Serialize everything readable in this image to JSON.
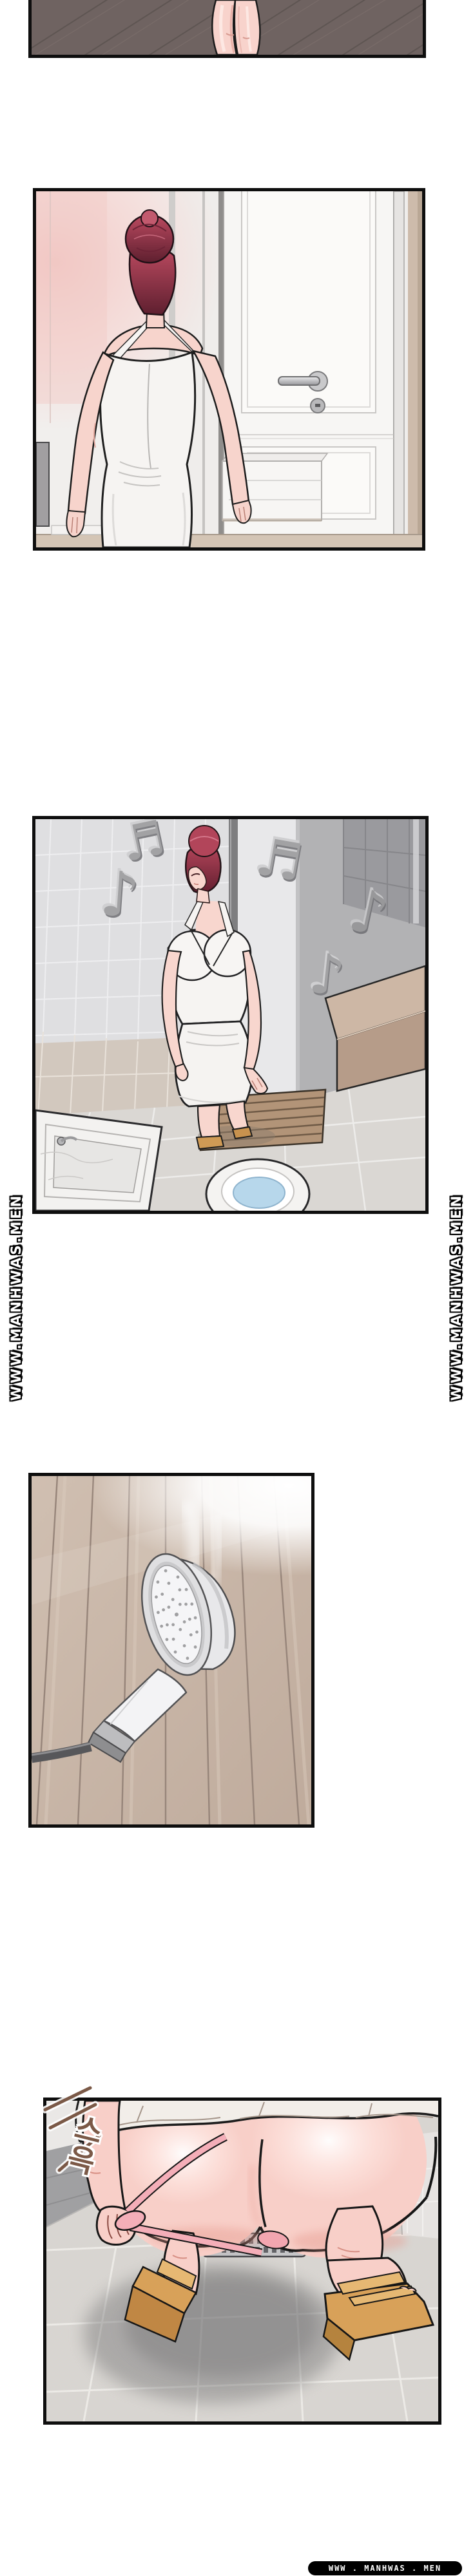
{
  "page": {
    "kind": "manhwa-webtoon-page",
    "background": "#ffffff",
    "panel_border": "#0e0e0e"
  },
  "watermarks": {
    "side": {
      "text": "WWW.MANHWAS.MEN",
      "color": "#ffffff",
      "outline": "#000000"
    },
    "bottom": {
      "text": "WWW . MANHWAS . MEN",
      "color": "#ffffff",
      "bg": "#000000"
    }
  },
  "sfx": {
    "text": "스윽",
    "color": "#7b5947"
  },
  "icons": {
    "eighth_note": "♪",
    "beamed_note": "♬"
  },
  "palette": {
    "skin": "#f8cfc8",
    "hair_red": "#b2455a",
    "dress_white": "#f6f4f2",
    "dark_wood_floor": "#6f6361",
    "wood_wall": "#c8b5a7",
    "tile_gray": "#dedee0",
    "note_gray": "#a2a2a4",
    "counter_tan": "#cdb7a5",
    "sandal_tan": "#d8a159",
    "panty_pink": "#f4aeb8",
    "water_blue": "#b7d7eb"
  },
  "panels": [
    {
      "label": "bare legs standing on dark diagonal wood floor"
    },
    {
      "label": "woman in white halter dress seen from behind walking toward a white door"
    },
    {
      "label": "woman humming in tiled bathroom with music notes, counter, tub and toilet"
    },
    {
      "label": "handheld shower head hanging against wooden slat wall with steam"
    },
    {
      "label": "woman squatting on tiled shower floor pulling down pink underwear, wedge sandals"
    }
  ]
}
